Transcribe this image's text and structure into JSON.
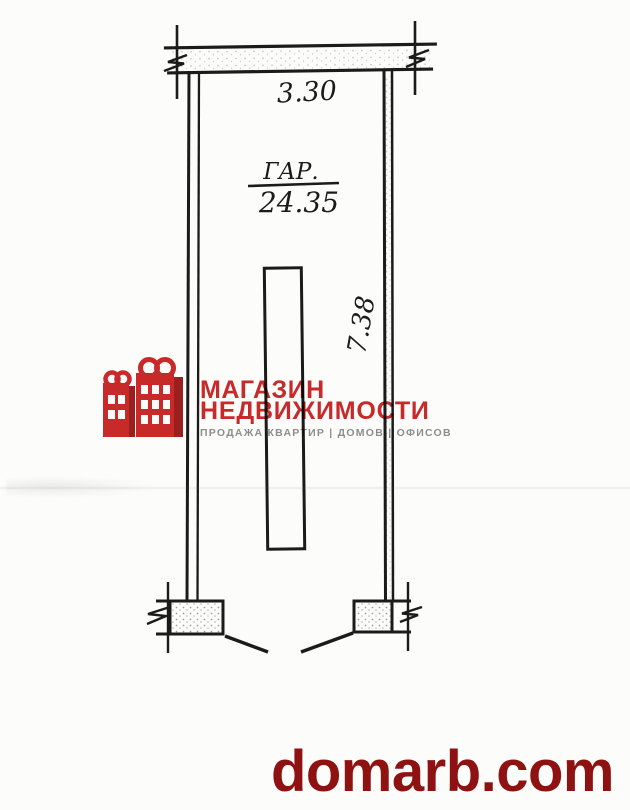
{
  "plan": {
    "width_dimension": "3.30",
    "room_abbreviation": "ГАР.",
    "room_area": "24.35",
    "height_dimension": "7.38",
    "ink_color": "#1b1b1b"
  },
  "watermark_logo": {
    "icon": "red-buildings-shopping-bag-icon",
    "title_line1": "МАГАЗИН",
    "title_line2": "НЕДВИЖИМОСТИ",
    "tagline": "ПРОДАЖА КВАРТИР | ДОМОВ | ОФИСОВ",
    "accent_color": "#cb2a2a",
    "tagline_color": "#8f8f8f"
  },
  "footer": {
    "website": "domarb.com",
    "color": "#8e1212"
  }
}
